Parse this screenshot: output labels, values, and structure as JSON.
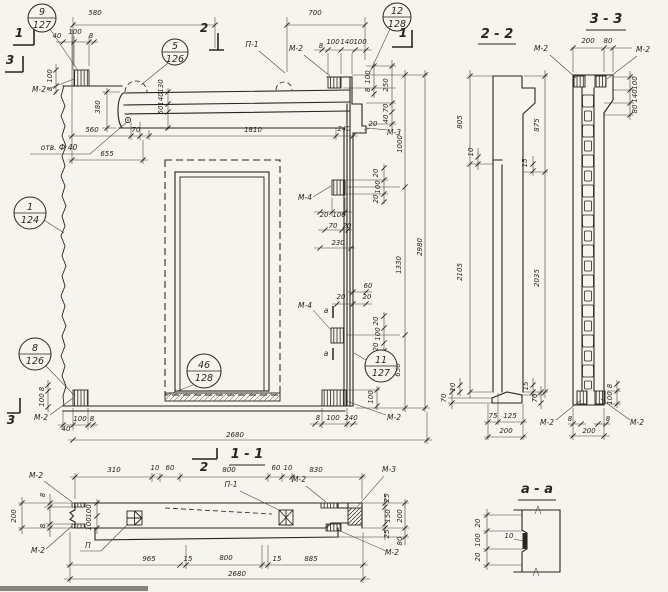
{
  "meta": {
    "drawing_type": "precast concrete wall panel working drawing",
    "paper_color": "#f5f4ef",
    "ink_color": "#29251f",
    "views": {
      "main": "panel elevation",
      "s22": "vertical section 2-2",
      "s33": "vertical section 3-3",
      "s11": "horizontal section 1-1",
      "saa": "detail a-a"
    }
  },
  "labels": [
    {
      "t": "580",
      "x": 95,
      "y": 15
    },
    {
      "t": "700",
      "x": 315,
      "y": 15
    },
    {
      "t": "40",
      "x": 57,
      "y": 38
    },
    {
      "t": "100",
      "x": 75,
      "y": 34
    },
    {
      "t": "8",
      "x": 91,
      "y": 38
    },
    {
      "t": "8",
      "x": 321,
      "y": 48
    },
    {
      "t": "100",
      "x": 333,
      "y": 44
    },
    {
      "t": "140",
      "x": 347,
      "y": 44
    },
    {
      "t": "100",
      "x": 360,
      "y": 44
    },
    {
      "t": "П-1",
      "x": 252,
      "y": 47,
      "k": "L"
    },
    {
      "t": "М-2",
      "x": 296,
      "y": 51,
      "k": "L"
    },
    {
      "t": "М-2",
      "x": 39,
      "y": 92,
      "k": "L"
    },
    {
      "t": "100",
      "x": 52,
      "y": 76,
      "v": 1
    },
    {
      "t": "8",
      "x": 52,
      "y": 89,
      "v": 1
    },
    {
      "t": "130",
      "x": 163,
      "y": 86,
      "v": 1
    },
    {
      "t": "140",
      "x": 163,
      "y": 99,
      "v": 1
    },
    {
      "t": "50",
      "x": 163,
      "y": 110,
      "v": 1
    },
    {
      "t": "380",
      "x": 100,
      "y": 107,
      "v": 1
    },
    {
      "t": "560",
      "x": 92,
      "y": 132
    },
    {
      "t": "70",
      "x": 136,
      "y": 132
    },
    {
      "t": "1810",
      "x": 253,
      "y": 132
    },
    {
      "t": "240",
      "x": 344,
      "y": 131
    },
    {
      "t": "отв. Ф 40",
      "x": 59,
      "y": 150,
      "k": "L"
    },
    {
      "t": "655",
      "x": 107,
      "y": 156
    },
    {
      "t": "100",
      "x": 370,
      "y": 77,
      "v": 1
    },
    {
      "t": "8",
      "x": 370,
      "y": 90,
      "v": 1
    },
    {
      "t": "250",
      "x": 388,
      "y": 85,
      "v": 1
    },
    {
      "t": "70",
      "x": 388,
      "y": 108,
      "v": 1
    },
    {
      "t": "40",
      "x": 388,
      "y": 119,
      "v": 1
    },
    {
      "t": "20",
      "x": 373,
      "y": 126
    },
    {
      "t": "М-3",
      "x": 394,
      "y": 135,
      "k": "L"
    },
    {
      "t": "1000",
      "x": 402,
      "y": 144,
      "v": 1
    },
    {
      "t": "20",
      "x": 378,
      "y": 173,
      "v": 1
    },
    {
      "t": "100",
      "x": 380,
      "y": 187,
      "v": 1
    },
    {
      "t": "20",
      "x": 378,
      "y": 199,
      "v": 1
    },
    {
      "t": "М-4",
      "x": 305,
      "y": 200,
      "k": "L"
    },
    {
      "t": "20",
      "x": 324,
      "y": 217
    },
    {
      "t": "100",
      "x": 339,
      "y": 217
    },
    {
      "t": "70",
      "x": 333,
      "y": 228
    },
    {
      "t": "20",
      "x": 347,
      "y": 228
    },
    {
      "t": "230",
      "x": 338,
      "y": 245
    },
    {
      "t": "1330",
      "x": 401,
      "y": 265,
      "v": 1
    },
    {
      "t": "2980",
      "x": 422,
      "y": 247,
      "v": 1
    },
    {
      "t": "60",
      "x": 368,
      "y": 288
    },
    {
      "t": "20",
      "x": 341,
      "y": 299
    },
    {
      "t": "20",
      "x": 367,
      "y": 299
    },
    {
      "t": "М-4",
      "x": 305,
      "y": 308,
      "k": "L"
    },
    {
      "t": "а",
      "x": 326,
      "y": 313,
      "k": "L"
    },
    {
      "t": "а",
      "x": 326,
      "y": 356,
      "k": "L"
    },
    {
      "t": "20",
      "x": 378,
      "y": 321,
      "v": 1
    },
    {
      "t": "100",
      "x": 380,
      "y": 334,
      "v": 1
    },
    {
      "t": "20",
      "x": 378,
      "y": 347,
      "v": 1
    },
    {
      "t": "650",
      "x": 400,
      "y": 370,
      "v": 1
    },
    {
      "t": "100",
      "x": 373,
      "y": 397,
      "v": 1
    },
    {
      "t": "8",
      "x": 318,
      "y": 420
    },
    {
      "t": "100",
      "x": 333,
      "y": 420
    },
    {
      "t": "240",
      "x": 351,
      "y": 420
    },
    {
      "t": "М-2",
      "x": 394,
      "y": 420,
      "k": "L"
    },
    {
      "t": "8",
      "x": 44,
      "y": 389,
      "v": 1
    },
    {
      "t": "100",
      "x": 44,
      "y": 400,
      "v": 1
    },
    {
      "t": "М-2",
      "x": 41,
      "y": 420,
      "k": "L"
    },
    {
      "t": "100",
      "x": 80,
      "y": 421
    },
    {
      "t": "8",
      "x": 92,
      "y": 421
    },
    {
      "t": "40",
      "x": 66,
      "y": 431
    },
    {
      "t": "2680",
      "x": 235,
      "y": 437
    },
    {
      "t": "2 - 2",
      "x": 497,
      "y": 38,
      "k": "t"
    },
    {
      "t": "805",
      "x": 462,
      "y": 122,
      "v": 1
    },
    {
      "t": "875",
      "x": 539,
      "y": 125,
      "v": 1
    },
    {
      "t": "10",
      "x": 473,
      "y": 152,
      "v": 1
    },
    {
      "t": "15",
      "x": 527,
      "y": 163,
      "v": 1
    },
    {
      "t": "2105",
      "x": 462,
      "y": 272,
      "v": 1
    },
    {
      "t": "2035",
      "x": 539,
      "y": 278,
      "v": 1
    },
    {
      "t": "10",
      "x": 455,
      "y": 387,
      "v": 1
    },
    {
      "t": "70",
      "x": 446,
      "y": 398,
      "v": 1
    },
    {
      "t": "15",
      "x": 528,
      "y": 386,
      "v": 1
    },
    {
      "t": "70",
      "x": 537,
      "y": 398,
      "v": 1
    },
    {
      "t": "75",
      "x": 493,
      "y": 418
    },
    {
      "t": "125",
      "x": 510,
      "y": 418
    },
    {
      "t": "200",
      "x": 506,
      "y": 433
    },
    {
      "t": "3 - 3",
      "x": 606,
      "y": 23,
      "k": "t"
    },
    {
      "t": "200",
      "x": 588,
      "y": 43
    },
    {
      "t": "80",
      "x": 608,
      "y": 43
    },
    {
      "t": "М-2",
      "x": 541,
      "y": 51,
      "k": "L"
    },
    {
      "t": "М-2",
      "x": 643,
      "y": 52,
      "k": "L"
    },
    {
      "t": "100",
      "x": 637,
      "y": 83,
      "v": 1
    },
    {
      "t": "140",
      "x": 637,
      "y": 96,
      "v": 1
    },
    {
      "t": "80",
      "x": 637,
      "y": 109,
      "v": 1
    },
    {
      "t": "8",
      "x": 612,
      "y": 386,
      "v": 1
    },
    {
      "t": "100",
      "x": 612,
      "y": 398,
      "v": 1
    },
    {
      "t": "М-2",
      "x": 547,
      "y": 425,
      "k": "L"
    },
    {
      "t": "8",
      "x": 570,
      "y": 421
    },
    {
      "t": "8",
      "x": 608,
      "y": 421
    },
    {
      "t": "М-2",
      "x": 637,
      "y": 425,
      "k": "L"
    },
    {
      "t": "200",
      "x": 589,
      "y": 433
    },
    {
      "t": "1 - 1",
      "x": 247,
      "y": 458,
      "k": "t"
    },
    {
      "t": "М-2",
      "x": 36,
      "y": 478,
      "k": "L"
    },
    {
      "t": "М-2",
      "x": 38,
      "y": 553,
      "k": "L"
    },
    {
      "t": "8",
      "x": 45,
      "y": 495,
      "v": 1
    },
    {
      "t": "8",
      "x": 45,
      "y": 526,
      "v": 1
    },
    {
      "t": "200",
      "x": 16,
      "y": 516,
      "v": 1
    },
    {
      "t": "310",
      "x": 114,
      "y": 472
    },
    {
      "t": "10",
      "x": 155,
      "y": 470
    },
    {
      "t": "60",
      "x": 170,
      "y": 470
    },
    {
      "t": "800",
      "x": 229,
      "y": 472
    },
    {
      "t": "60",
      "x": 276,
      "y": 470
    },
    {
      "t": "10",
      "x": 288,
      "y": 470
    },
    {
      "t": "830",
      "x": 316,
      "y": 472
    },
    {
      "t": "М-2",
      "x": 299,
      "y": 482,
      "k": "L"
    },
    {
      "t": "М-3",
      "x": 389,
      "y": 472,
      "k": "L"
    },
    {
      "t": "П-1",
      "x": 231,
      "y": 487,
      "k": "L"
    },
    {
      "t": "100",
      "x": 91,
      "y": 511,
      "v": 1
    },
    {
      "t": "100",
      "x": 91,
      "y": 524,
      "v": 1
    },
    {
      "t": "П",
      "x": 88,
      "y": 548,
      "k": "L"
    },
    {
      "t": "25",
      "x": 389,
      "y": 498,
      "v": 1
    },
    {
      "t": "150",
      "x": 390,
      "y": 516,
      "v": 1
    },
    {
      "t": "25",
      "x": 389,
      "y": 534,
      "v": 1
    },
    {
      "t": "200",
      "x": 402,
      "y": 516,
      "v": 1
    },
    {
      "t": "80",
      "x": 402,
      "y": 541,
      "v": 1
    },
    {
      "t": "965",
      "x": 149,
      "y": 561
    },
    {
      "t": "15",
      "x": 188,
      "y": 561
    },
    {
      "t": "800",
      "x": 226,
      "y": 560
    },
    {
      "t": "15",
      "x": 277,
      "y": 561
    },
    {
      "t": "885",
      "x": 311,
      "y": 561
    },
    {
      "t": "2680",
      "x": 237,
      "y": 576
    },
    {
      "t": "М-2",
      "x": 392,
      "y": 555,
      "k": "L"
    },
    {
      "t": "а - а",
      "x": 537,
      "y": 493,
      "k": "t"
    },
    {
      "t": "20",
      "x": 480,
      "y": 523,
      "v": 1
    },
    {
      "t": "100",
      "x": 480,
      "y": 540,
      "v": 1
    },
    {
      "t": "20",
      "x": 480,
      "y": 557,
      "v": 1
    },
    {
      "t": "10",
      "x": 509,
      "y": 538
    }
  ],
  "callouts": [
    {
      "top": "9",
      "bottom": "127",
      "x": 42,
      "y": 18,
      "r": 14,
      "leader": [
        50,
        29,
        77,
        69
      ]
    },
    {
      "top": "5",
      "bottom": "126",
      "x": 175,
      "y": 52,
      "r": 13,
      "leader": [
        168,
        63,
        141,
        85
      ]
    },
    {
      "top": "12",
      "bottom": "128",
      "x": 397,
      "y": 17,
      "r": 14,
      "leader": [
        390,
        29,
        369,
        74
      ]
    },
    {
      "top": "1",
      "bottom": "124",
      "x": 30,
      "y": 213,
      "r": 16,
      "leader": [
        44,
        220,
        64,
        233
      ]
    },
    {
      "top": "8",
      "bottom": "126",
      "x": 35,
      "y": 354,
      "r": 16,
      "leader": [
        46,
        366,
        74,
        395
      ]
    },
    {
      "top": "46",
      "bottom": "128",
      "x": 204,
      "y": 371,
      "r": 17,
      "leader": [
        193,
        385,
        167,
        395
      ]
    },
    {
      "top": "11",
      "bottom": "127",
      "x": 381,
      "y": 366,
      "r": 16,
      "leader": [
        366,
        360,
        354,
        353
      ]
    }
  ],
  "section_marks": [
    {
      "label": "1",
      "x": 19,
      "y": 37,
      "path": "M13,45 H34 M34,45 V29"
    },
    {
      "label": "3",
      "x": 10,
      "y": 64,
      "path": "M5,72 H23 M23,72 V56"
    },
    {
      "label": "2",
      "x": 204,
      "y": 32,
      "path": "M218,33 V50 M209,50 H224"
    },
    {
      "label": "1",
      "x": 403,
      "y": 37,
      "path": "M392,47 H413 M412,47 V30"
    },
    {
      "label": "3",
      "x": 11,
      "y": 424,
      "path": "M7,413 H20 M20,413 V398"
    },
    {
      "label": "2",
      "x": 204,
      "y": 471,
      "path": "M192,459 H217 M217,459 V448"
    }
  ]
}
